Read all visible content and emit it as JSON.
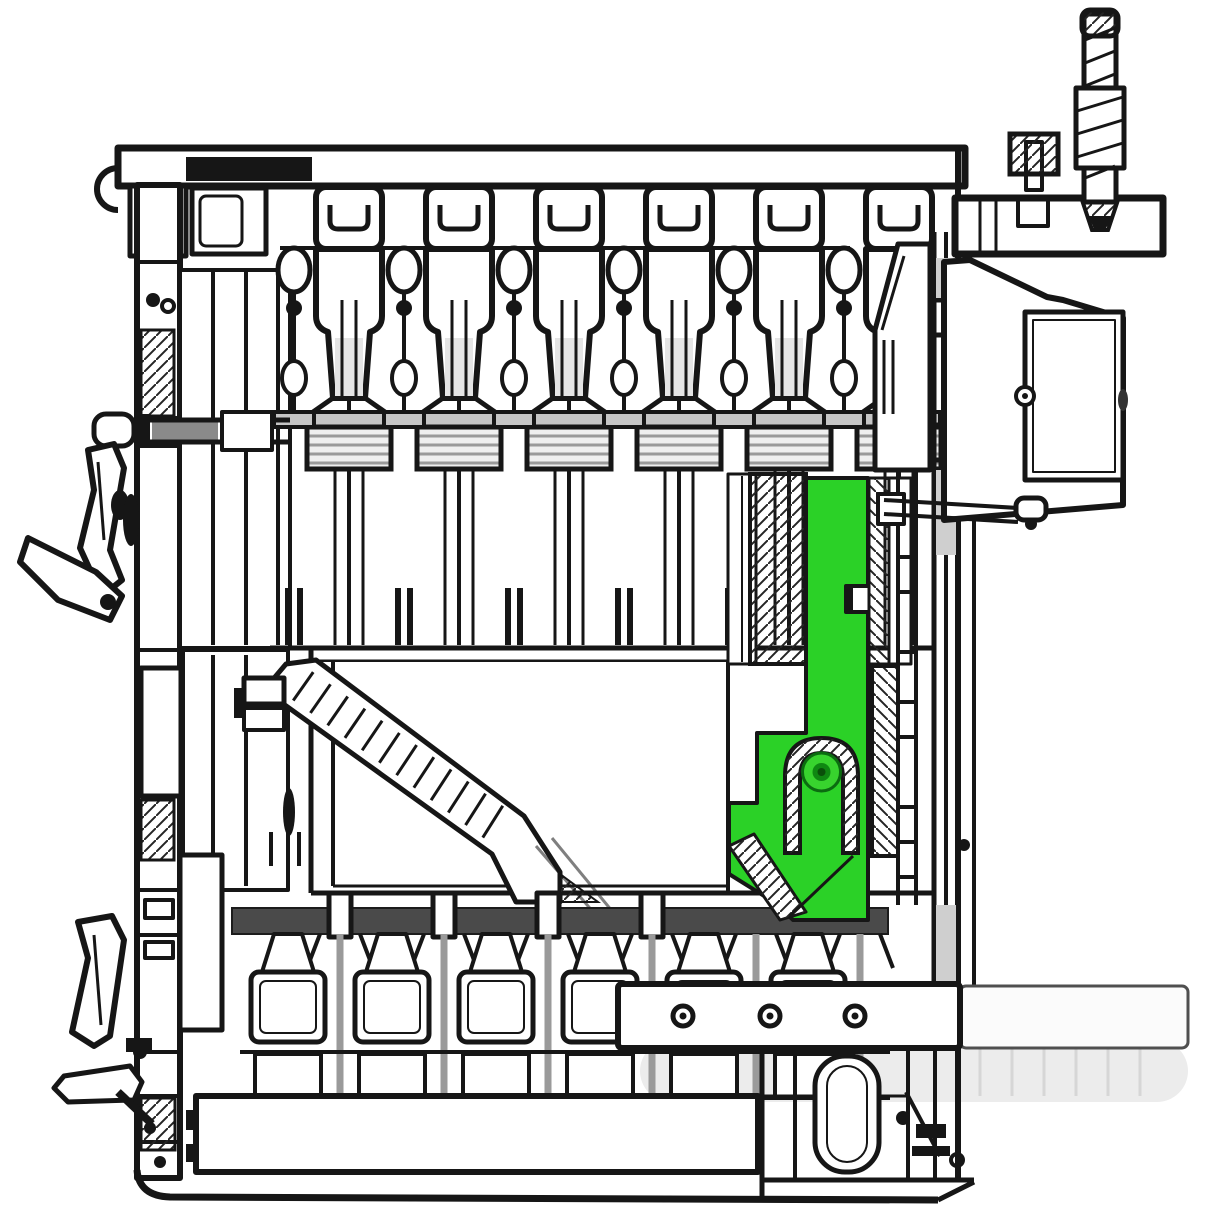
{
  "meta": {
    "domain": "Diagram",
    "subject": "Sectional boiler engineering cross-section",
    "description": "Black-and-white technical cutaway drawing of a sectional heating boiler; one internal latch bracket component is highlighted in green",
    "background": "#ffffff"
  },
  "colors": {
    "ink": "#161616",
    "mid_gray": "#c6c6c6",
    "grate": "#4a4a4a",
    "ghost": "#ececec",
    "ghost_line": "#d8d8d8",
    "extension_stroke": "#4f4f4f"
  },
  "highlight": {
    "part_name": "highlighted-latch-bracket",
    "fill": "#2bd127",
    "pin_ring": "#38d32e",
    "pin_ring_stroke": "#0b6b10",
    "pin_mid": "#0f8712",
    "pin_core": "#0a4f0a"
  },
  "parts": [
    {
      "name": "outer-casing"
    },
    {
      "name": "top-heat-exchanger-sections"
    },
    {
      "name": "combustion-chamber"
    },
    {
      "name": "feed-chute"
    },
    {
      "name": "grate-strip"
    },
    {
      "name": "bottom-heat-exchanger-sections"
    },
    {
      "name": "door-handles"
    },
    {
      "name": "flue-side-box"
    },
    {
      "name": "threaded-safety-rod"
    },
    {
      "name": "bolt-flange-bar"
    },
    {
      "name": "highlighted-latch-bracket"
    }
  ],
  "top_sections": {
    "count": 6,
    "centers": [
      349,
      459,
      569,
      679,
      789,
      899
    ]
  },
  "connectors": {
    "count": 6,
    "centers": [
      294,
      404,
      514,
      624,
      734,
      844
    ]
  },
  "bottom_sections": {
    "count": 6,
    "centers": [
      288,
      392,
      496,
      600,
      704,
      808
    ]
  },
  "post_fins": {
    "centers": [
      340,
      444,
      548,
      652,
      756,
      860
    ]
  },
  "grate_posts": {
    "centers": [
      340,
      444,
      548,
      652
    ]
  },
  "bolt_bar": {
    "hole_centers": [
      683,
      770,
      855
    ],
    "hole_y": 1016
  },
  "ladder": {
    "upper_rung_ys": [
      300,
      335,
      425,
      460
    ],
    "lower_rung_ys": [
      557,
      592,
      652,
      702,
      737,
      807,
      842,
      877
    ]
  },
  "chute": {
    "rung_count": 12
  },
  "rod": {
    "thread_count": 7
  },
  "ghost": {
    "line_xs": [
      980,
      1012,
      1044,
      1076,
      1108,
      1140
    ]
  }
}
